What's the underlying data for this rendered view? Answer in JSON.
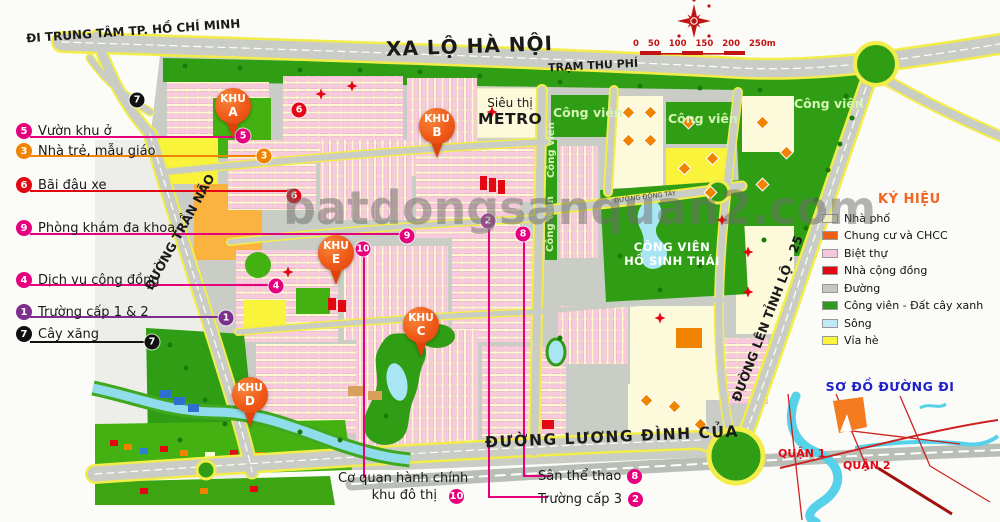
{
  "top_area": {
    "direction_label": "ĐI TRUNG TÂM TP. HỒ CHÍ MINH",
    "highway_name": "XA LỘ HÀ NỘI",
    "toll_station": "TRẠM THU PHÍ",
    "scale_ticks": [
      "0",
      "50",
      "100",
      "150",
      "200",
      "250m"
    ]
  },
  "watermark": "batdongsanquan2.com",
  "left_callouts": [
    {
      "num": "5",
      "color": "#E6007E",
      "label": "Vườn khu ở"
    },
    {
      "num": "3",
      "color": "#F08300",
      "label": "Nhà trẻ, mẫu giáo"
    },
    {
      "num": "6",
      "color": "#E30613",
      "label": "Bãi đậu xe"
    },
    {
      "num": "9",
      "color": "#E6007E",
      "label": "Phòng khám đa khoa"
    },
    {
      "num": "4",
      "color": "#E6007E",
      "label": "Dịch vụ cộng đồng"
    },
    {
      "num": "1",
      "color": "#7D2F8E",
      "label": "Trường cấp 1 & 2"
    },
    {
      "num": "7",
      "color": "#111111",
      "label": "Cây xăng"
    }
  ],
  "bottom_callouts": {
    "admin": {
      "line1": "Cơ quan hành chính",
      "line2": "khu đô thị",
      "num": "10",
      "color": "#E6007E"
    },
    "sports": {
      "label": "Sân thể thao",
      "num": "8",
      "color": "#E6007E"
    },
    "school3": {
      "label": "Trường cấp 3",
      "num": "2",
      "color": "#E6007E"
    }
  },
  "pins": [
    {
      "prefix": "KHU",
      "letter": "A"
    },
    {
      "prefix": "KHU",
      "letter": "B"
    },
    {
      "prefix": "KHU",
      "letter": "C"
    },
    {
      "prefix": "KHU",
      "letter": "D"
    },
    {
      "prefix": "KHU",
      "letter": "E"
    }
  ],
  "map_markers": [
    {
      "num": "7",
      "color": "#111111"
    },
    {
      "num": "5",
      "color": "#E6007E"
    },
    {
      "num": "3",
      "color": "#F08300"
    },
    {
      "num": "6",
      "color": "#E30613"
    },
    {
      "num": "6",
      "color": "#E30613"
    },
    {
      "num": "9",
      "color": "#E6007E"
    },
    {
      "num": "10",
      "color": "#E6007E"
    },
    {
      "num": "4",
      "color": "#E6007E"
    },
    {
      "num": "2",
      "color": "#A8439B"
    },
    {
      "num": "8",
      "color": "#E6007E"
    },
    {
      "num": "1",
      "color": "#7D2F8E"
    },
    {
      "num": "7",
      "color": "#111111"
    }
  ],
  "map_labels": {
    "supermarket_line1": "Siêu thị",
    "supermarket_line2": "METRO",
    "park": "Công viên",
    "eco_park_line1": "CÔNG VIÊN",
    "eco_park_line2": "HỒ SINH THÁI",
    "road_tran_nao": "ĐƯỜNG TRẦN NÃO",
    "road_tinh_lo": "ĐƯỜNG LÊN TỈNH LỘ - 25",
    "road_dong_tay": "ĐƯỜNG ĐÔNG TÂY",
    "road_luong_dinh_cua": "ĐƯỜNG LƯƠNG ĐÌNH CỦA"
  },
  "legend": {
    "title": "KÝ HIỆU",
    "items": [
      {
        "label": "Nhà phố",
        "color": "#F2F0C0"
      },
      {
        "label": "Chung cư và CHCC",
        "color": "#EE5F12"
      },
      {
        "label": "Biệt thự",
        "color": "#F6C6DB"
      },
      {
        "label": "Nhà cộng đồng",
        "color": "#E30613"
      },
      {
        "label": "Đường",
        "color": "#C4C9C0"
      },
      {
        "label": "Công viên - Đất cây xanh",
        "color": "#2F9A1D"
      },
      {
        "label": "Sông",
        "color": "#BFE9F5"
      },
      {
        "label": "Vỉa hè",
        "color": "#FBF33C"
      }
    ]
  },
  "minimap": {
    "title": "SƠ ĐỒ ĐƯỜNG ĐI",
    "district1": "QUẬN 1",
    "district2": "QUẬN 2"
  }
}
